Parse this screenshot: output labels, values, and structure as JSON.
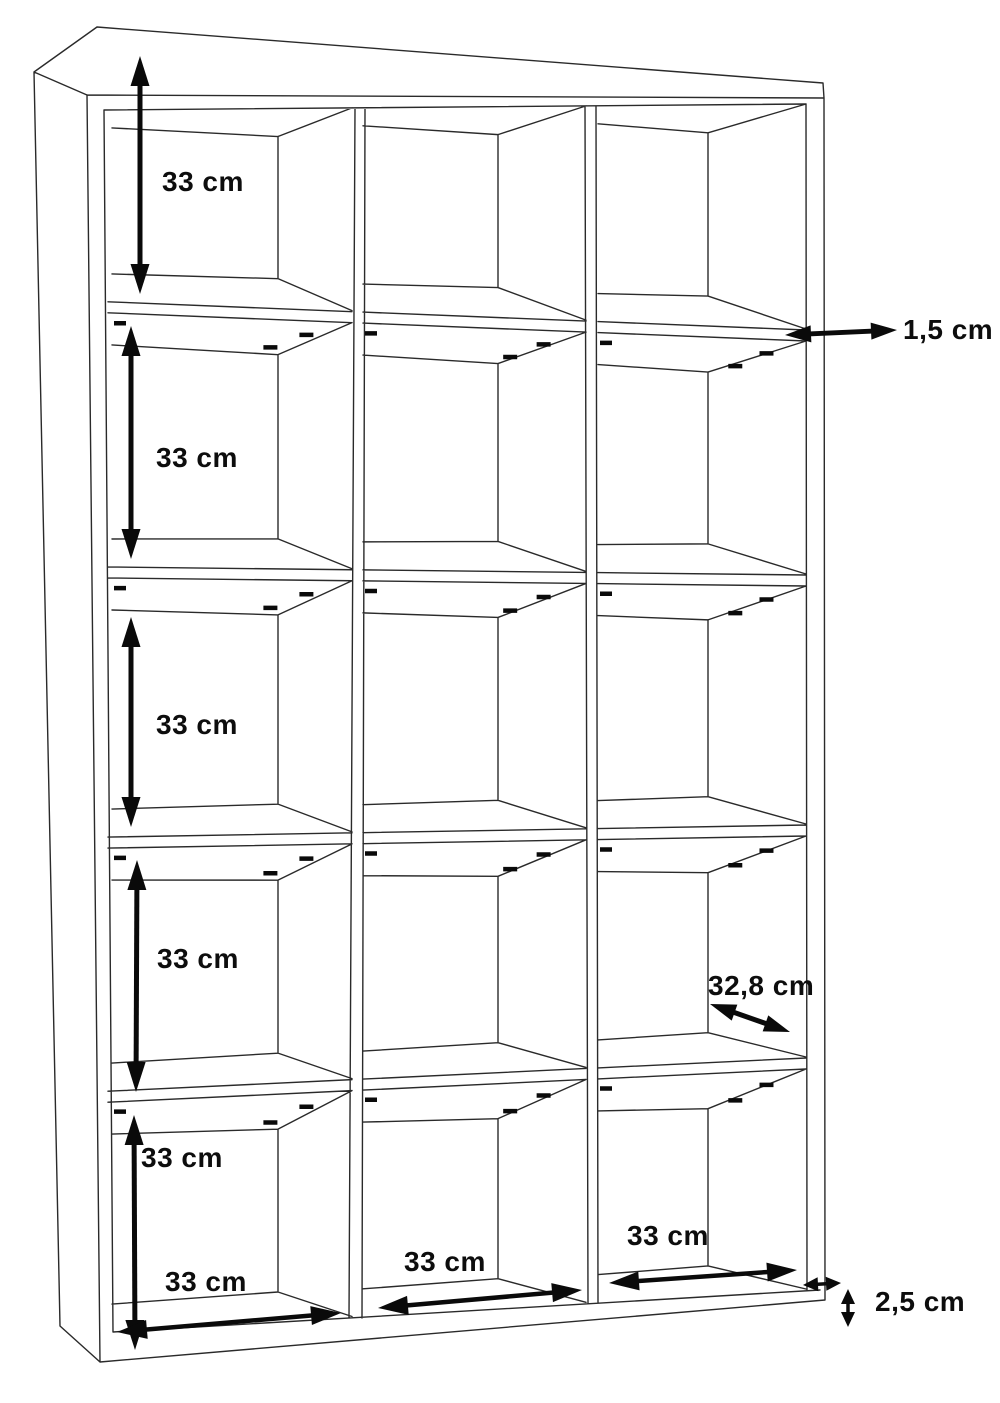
{
  "diagram": {
    "description": "Perspective line drawing of a 3x5 open cube shelving unit with dimension annotations",
    "unit_of_measure": "cm",
    "grid": {
      "columns": 3,
      "rows": 5,
      "compartments": 15
    },
    "colors": {
      "background": "#ffffff",
      "line": "#2a2a2a",
      "annotation": "#0a0a0a"
    },
    "labels": {
      "row1_height": "33 cm",
      "row2_height": "33 cm",
      "row3_height": "33 cm",
      "row4_height": "33 cm",
      "row5_height": "33 cm",
      "col1_width": "33 cm",
      "col2_width": "33 cm",
      "col3_width": "33 cm",
      "shelf_thickness": "1,5 cm",
      "inner_depth": "32,8 cm",
      "base_height": "2,5 cm"
    }
  }
}
